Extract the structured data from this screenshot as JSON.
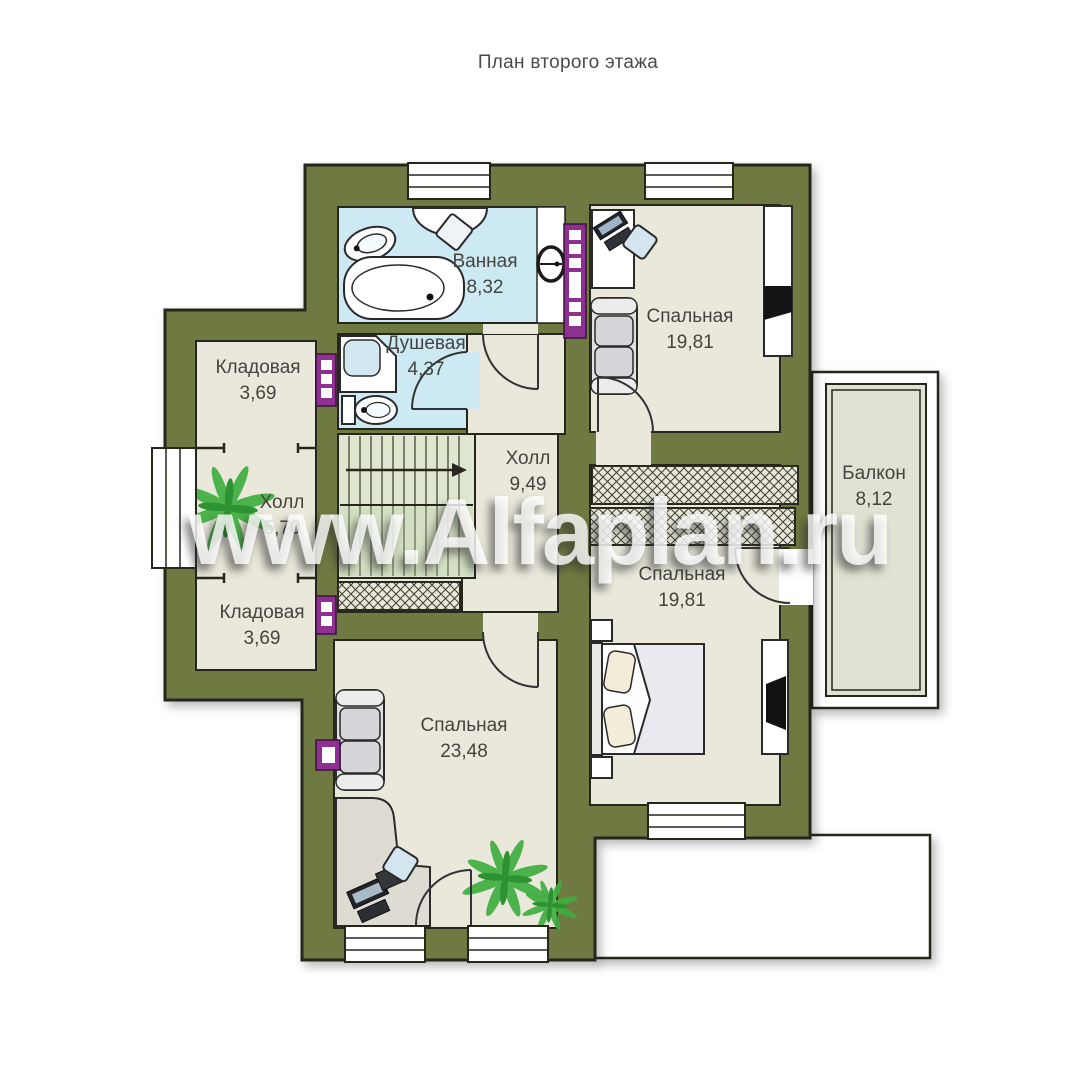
{
  "title": "План второго этажа",
  "watermark": "www.Alfaplan.ru",
  "rooms": [
    {
      "name": "Ванная",
      "area": "8,32"
    },
    {
      "name": "Душевая",
      "area": "4,37"
    },
    {
      "name": "Кладовая",
      "area": "3,69"
    },
    {
      "name": "Холл",
      "area": "5,70"
    },
    {
      "name": "Холл",
      "area": "9,49"
    },
    {
      "name": "Кладовая",
      "area": "3,69"
    },
    {
      "name": "Спальная",
      "area": "19,81"
    },
    {
      "name": "Спальная",
      "area": "19,81"
    },
    {
      "name": "Спальная",
      "area": "23,48"
    },
    {
      "name": "Балкон",
      "area": "8,12"
    }
  ],
  "colors": {
    "wall": "#6f7a42",
    "floor": "#eae8db",
    "wet_floor": "#cde9f3",
    "stairs": "#dfe7d0",
    "balcony_floor": "#e2e2d4",
    "radiator": "#8e2f92",
    "plant": "#3fae3f"
  }
}
